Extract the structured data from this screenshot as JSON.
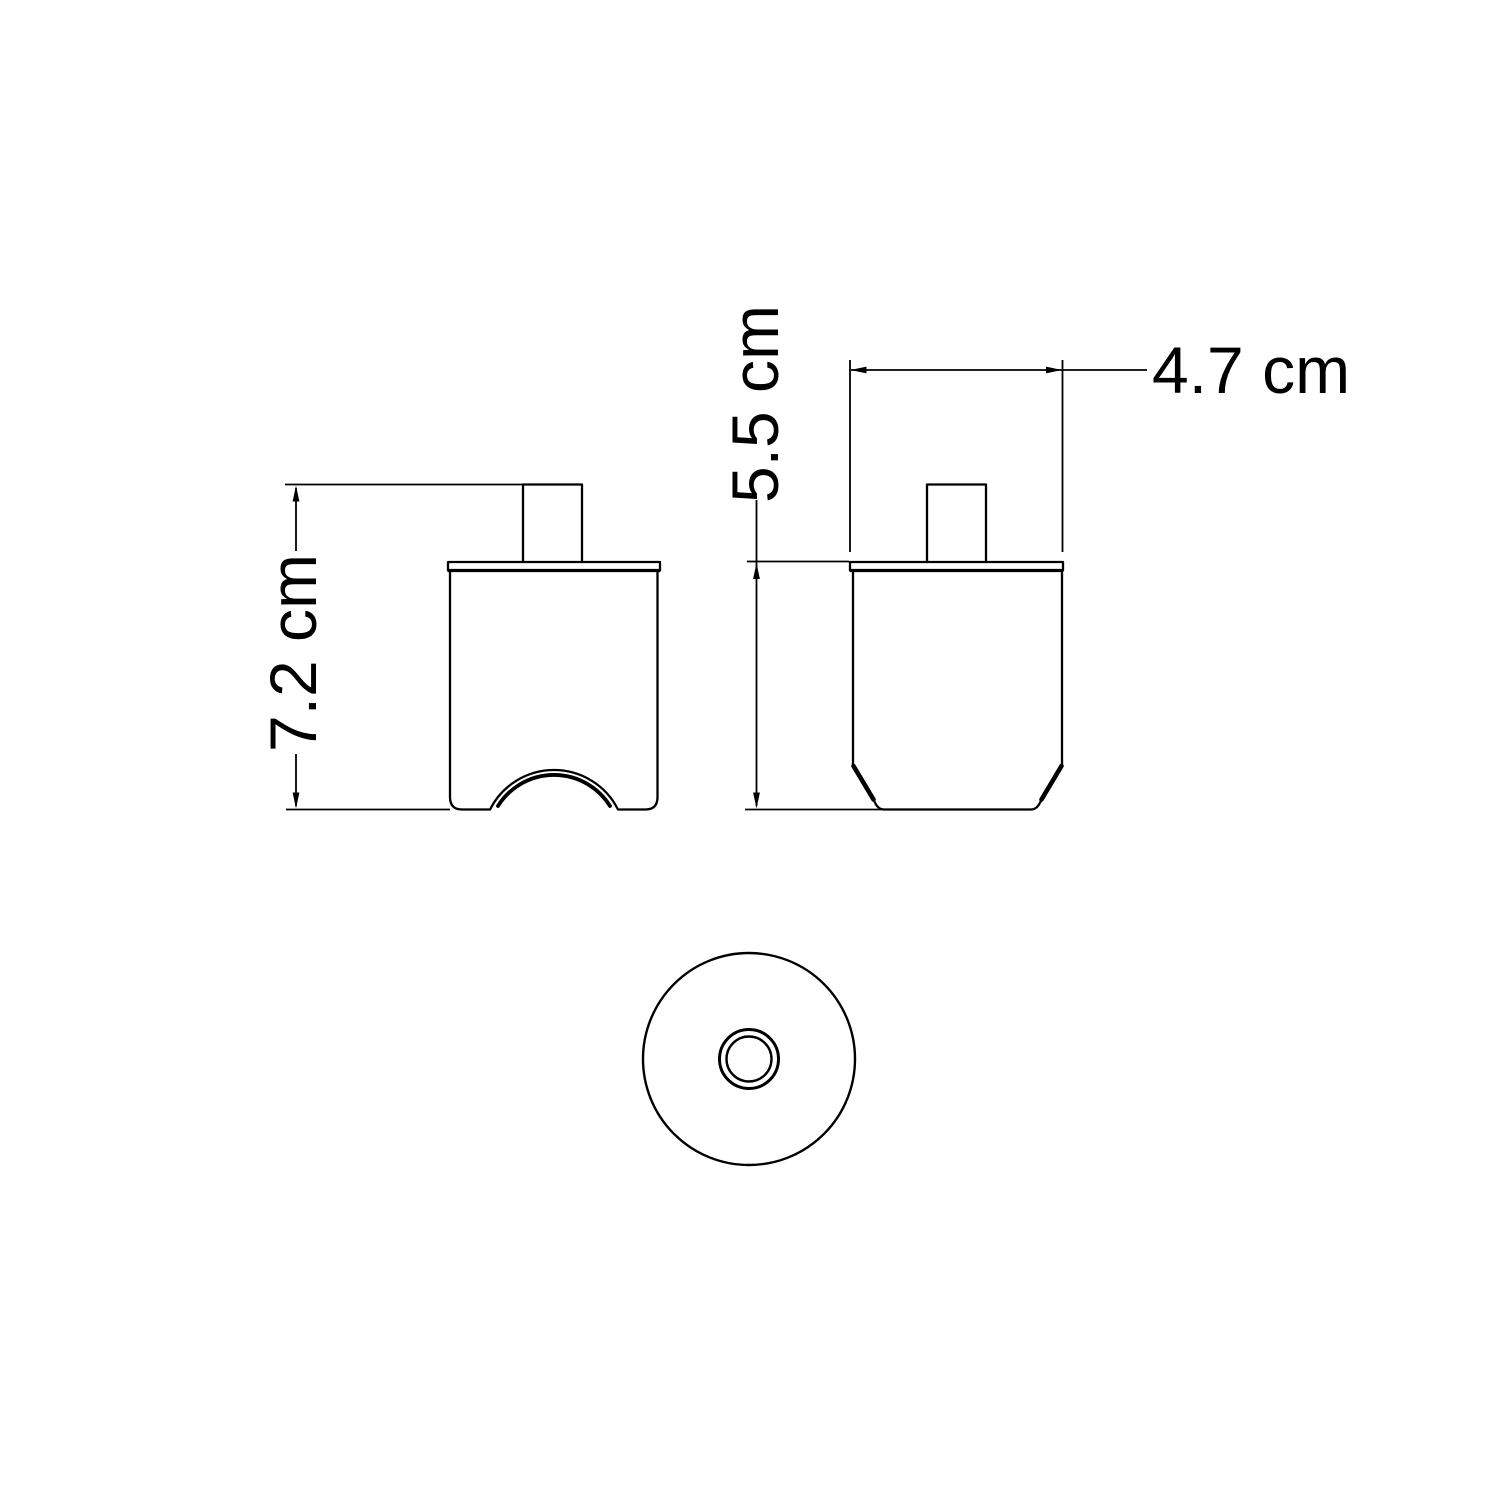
{
  "colors": {
    "line": "#000000",
    "background": "#ffffff"
  },
  "dimensions": {
    "front_height": {
      "value": 7.2,
      "unit": "cm",
      "label": "7.2 cm"
    },
    "side_height": {
      "value": 5.5,
      "unit": "cm",
      "label": "5.5 cm"
    },
    "width": {
      "value": 4.7,
      "unit": "cm",
      "label": "4.7 cm"
    }
  }
}
